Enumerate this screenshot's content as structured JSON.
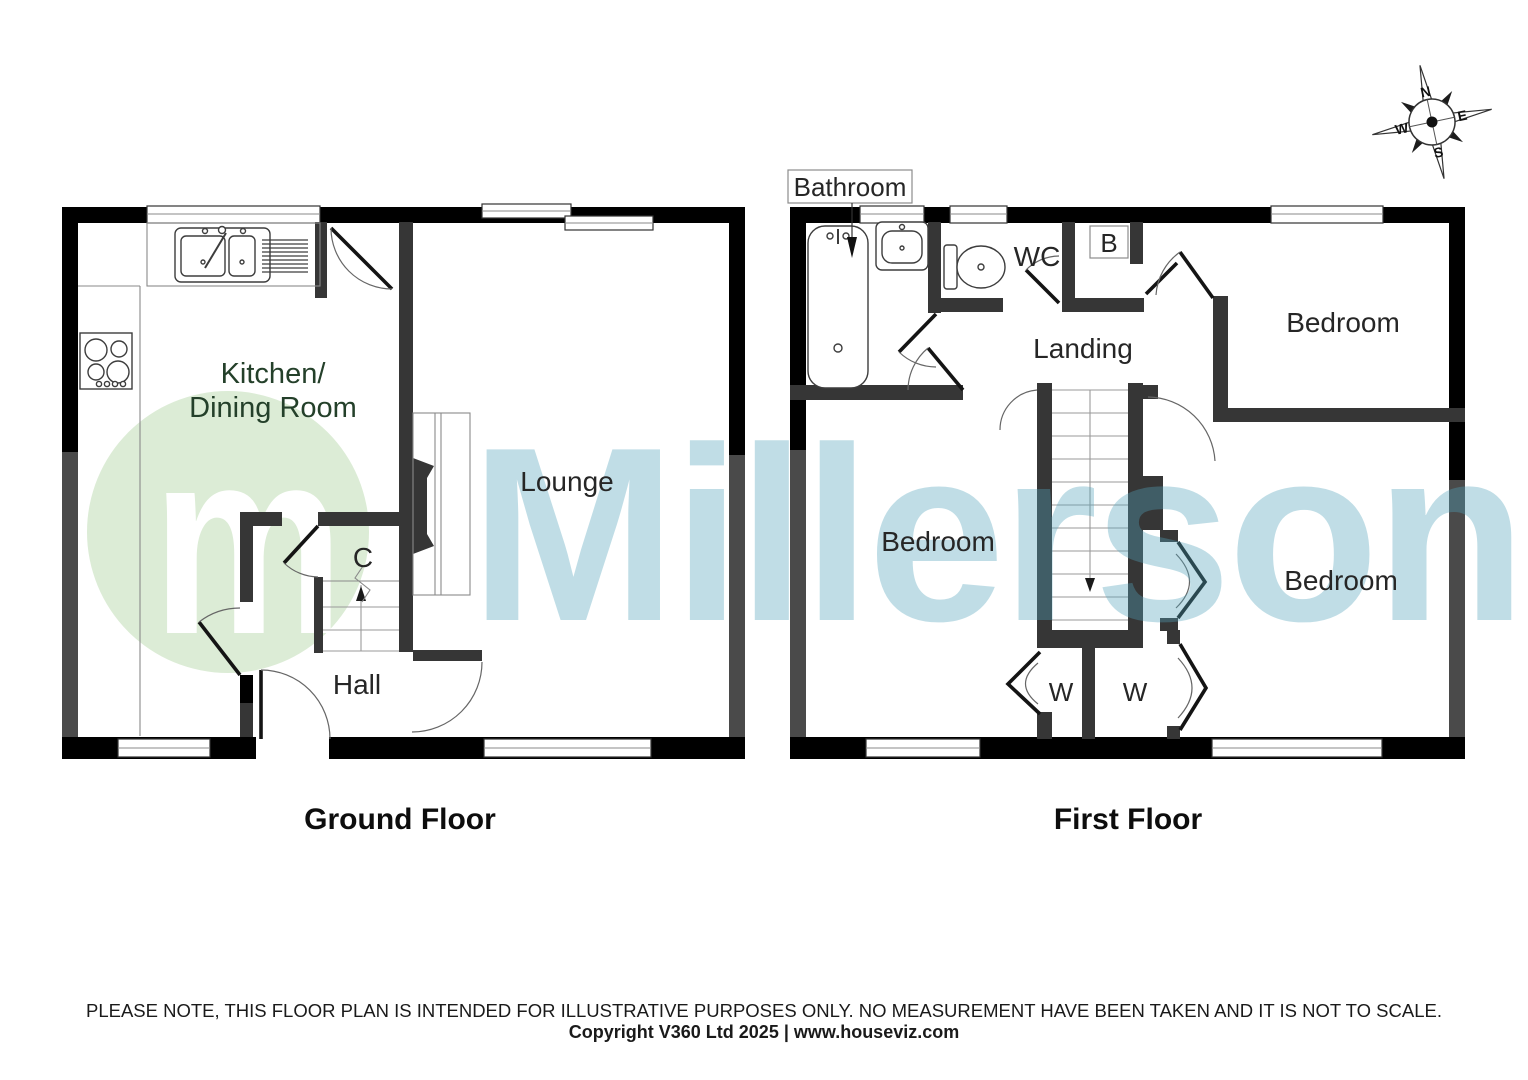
{
  "floorplan": {
    "brand_watermark": "Millerson",
    "logo_letter": "m",
    "ground_floor": {
      "caption": "Ground Floor",
      "rooms": {
        "kitchen_line1": "Kitchen/",
        "kitchen_line2": "Dining Room",
        "lounge": "Lounge",
        "hall": "Hall",
        "cupboard": "C"
      }
    },
    "first_floor": {
      "caption": "First Floor",
      "rooms": {
        "bathroom": "Bathroom",
        "wc": "WC",
        "boiler": "B",
        "landing": "Landing",
        "bedroom_top": "Bedroom",
        "bedroom_left": "Bedroom",
        "bedroom_right": "Bedroom",
        "wardrobe_left": "W",
        "wardrobe_right": "W"
      }
    },
    "compass": {
      "north": "N",
      "east": "E",
      "south": "S",
      "west": "W"
    },
    "footer": {
      "disclaimer": "PLEASE NOTE, THIS FLOOR PLAN IS INTENDED FOR ILLUSTRATIVE PURPOSES ONLY. NO MEASUREMENT HAVE BEEN TAKEN AND IT IS NOT TO SCALE.",
      "copyright": "Copyright V360 Ltd 2025 | www.houseviz.com"
    },
    "colors": {
      "exterior_wall": "#000000",
      "interior_wall": "#363636",
      "party_wall": "#4a4a4a",
      "watermark_green": "#dcecd6",
      "watermark_blue": "#52a4bb"
    }
  }
}
